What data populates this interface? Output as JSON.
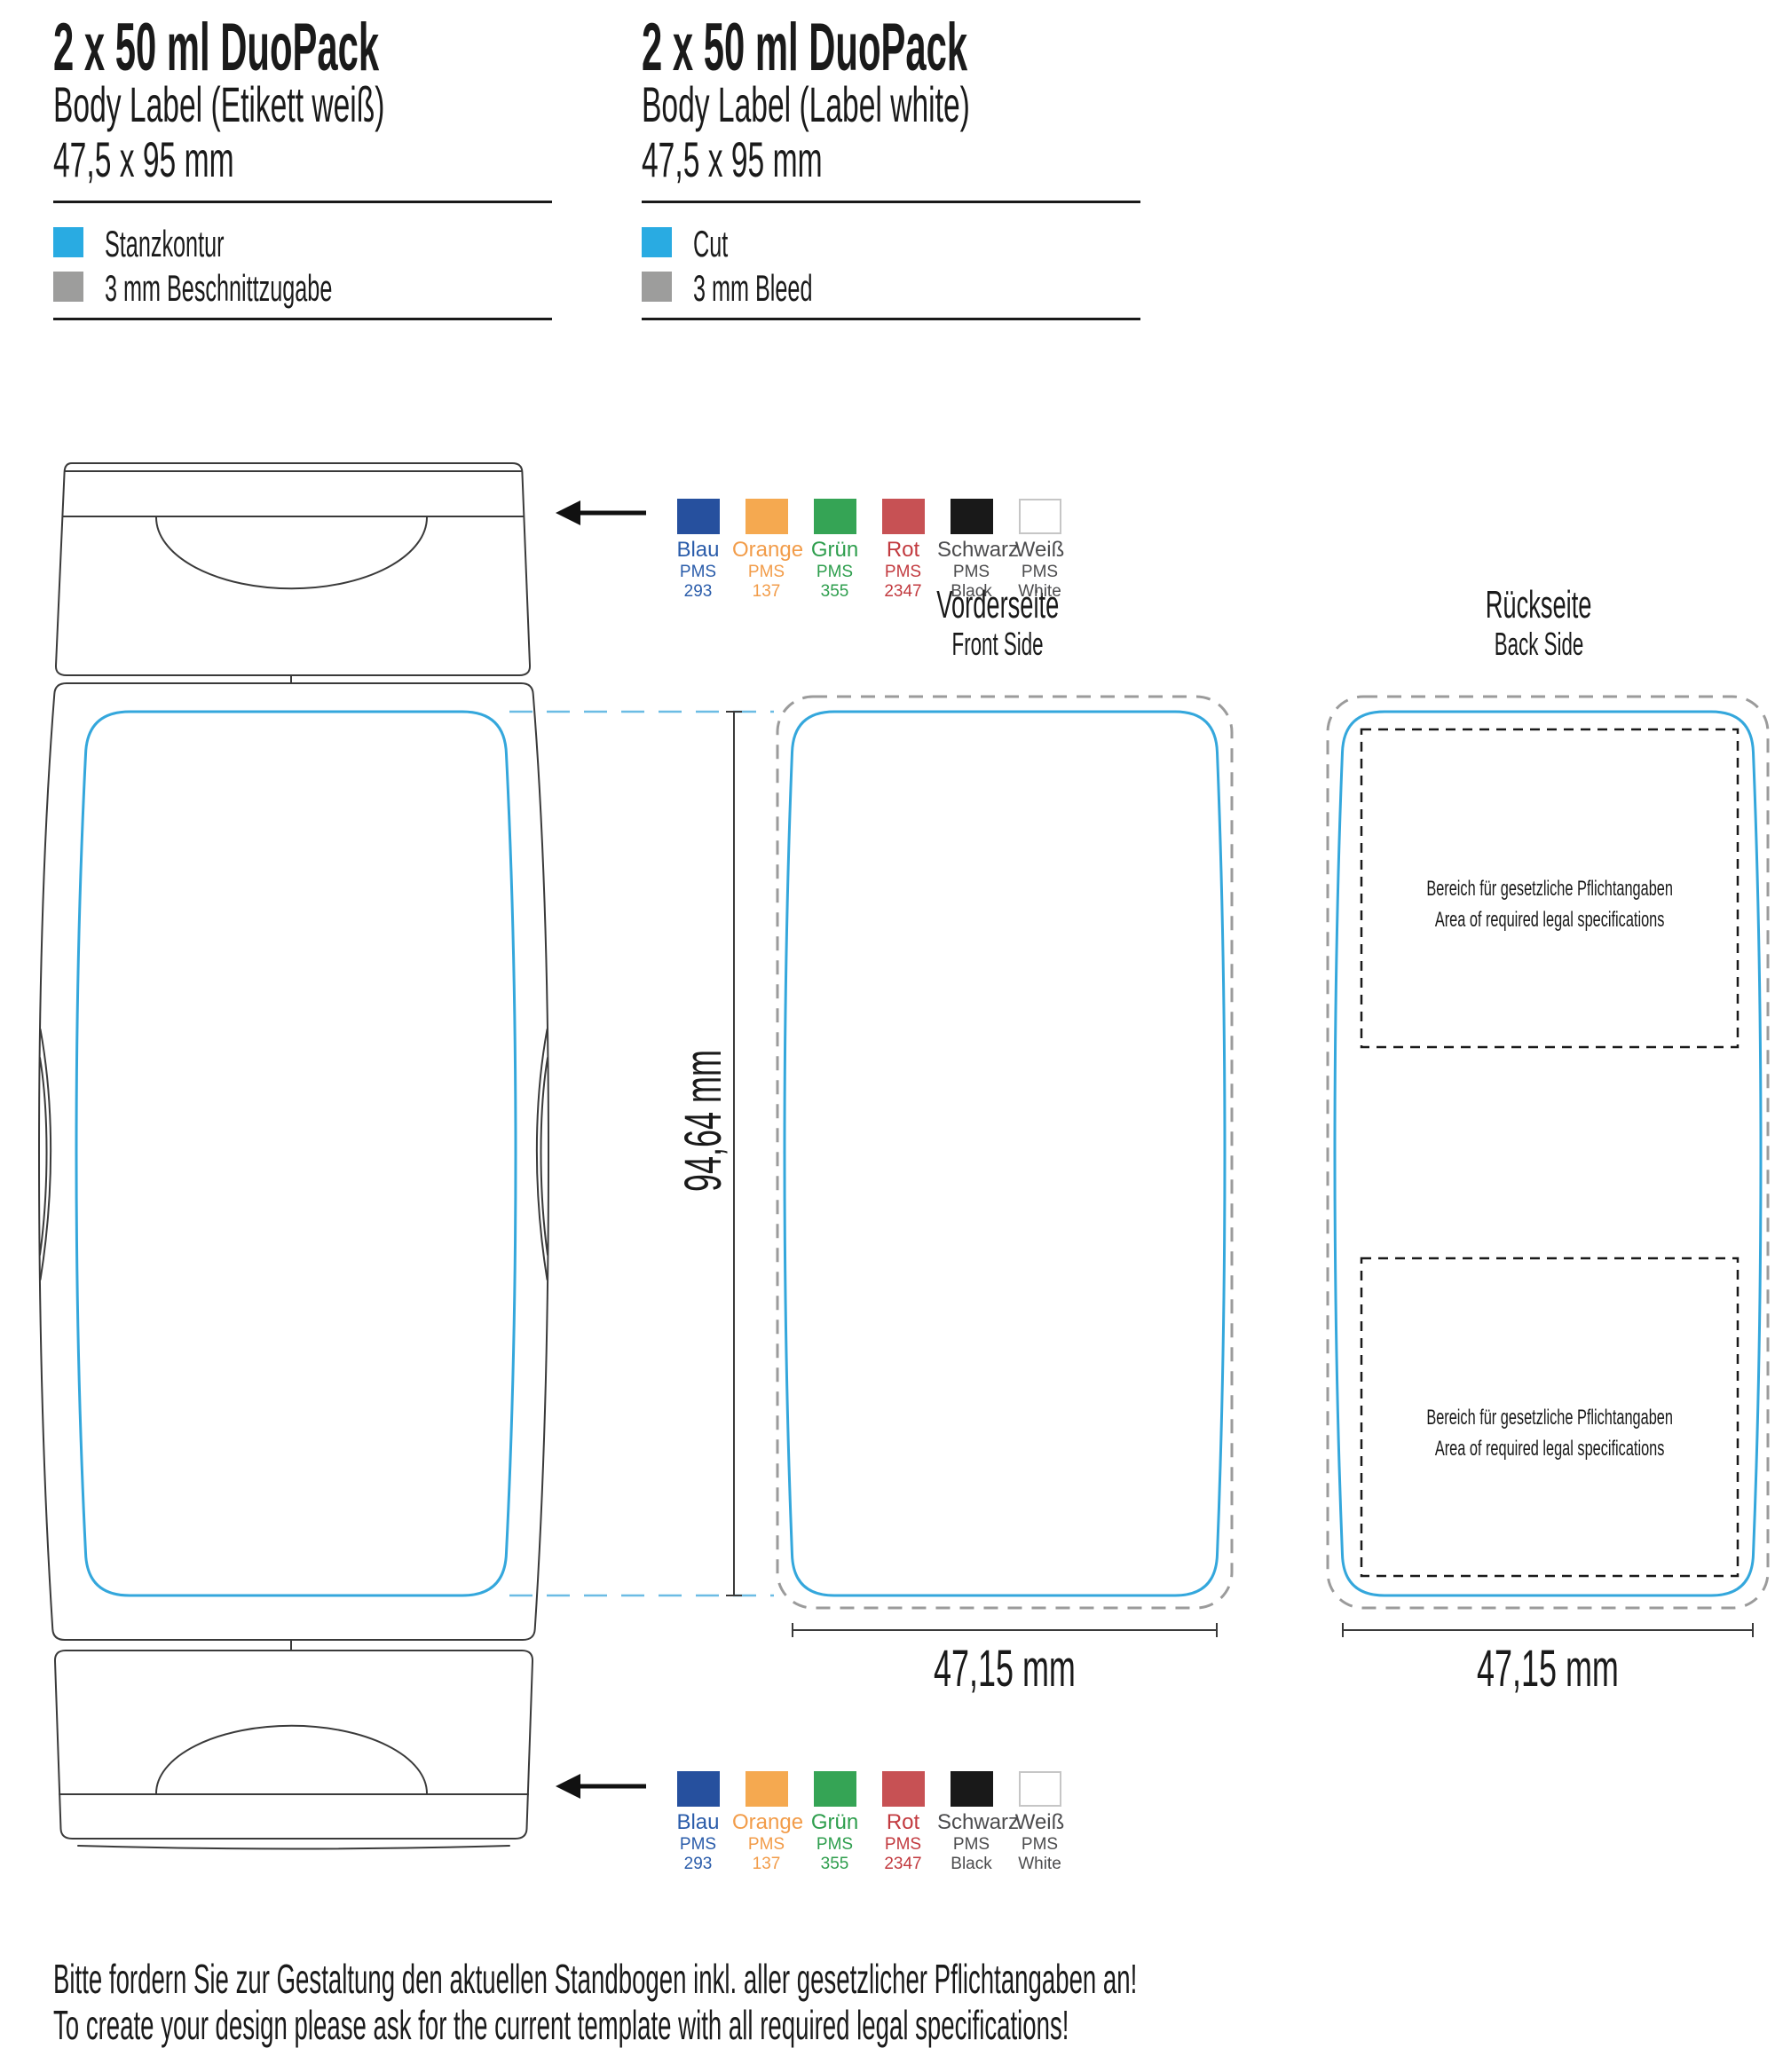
{
  "headers": {
    "de": {
      "title": "2 x 50 ml DuoPack",
      "subtitle": "Body Label (Etikett weiß)",
      "size": "47,5 x 95 mm",
      "legend": [
        {
          "label": "Stanzkontur",
          "color": "#29ABE2"
        },
        {
          "label": "3 mm Beschnittzugabe",
          "color": "#9D9D9C"
        }
      ]
    },
    "en": {
      "title": "2 x 50 ml DuoPack",
      "subtitle": "Body Label (Label white)",
      "size": "47,5 x 95 mm",
      "legend": [
        {
          "label": "Cut",
          "color": "#29ABE2"
        },
        {
          "label": "3 mm Bleed",
          "color": "#9D9D9C"
        }
      ]
    }
  },
  "sides": {
    "front": {
      "title": "Vorderseite",
      "subtitle": "Front Side",
      "width_label": "47,15 mm"
    },
    "back": {
      "title": "Rückseite",
      "subtitle": "Back Side",
      "width_label": "47,15 mm",
      "legal_line1": "Bereich für gesetzliche Pflichtangaben",
      "legal_line2": "Area of required legal specifications"
    }
  },
  "dimensions": {
    "label_height": "94,64 mm"
  },
  "colors": {
    "cut_contour": "#34A7DC",
    "cut_connector": "#6BBCE4",
    "bleed_contour": "#9B9B9B",
    "legal_box": "#1a1a1a",
    "bottle_outline": "#3A3A3A",
    "dimension_line": "#3A3A3A"
  },
  "swatches": {
    "items": [
      {
        "name": "Blau",
        "pms": "PMS 293",
        "hex": "#26509E",
        "text": "#2A5CAA",
        "border": "transparent"
      },
      {
        "name": "Orange",
        "pms": "PMS 137",
        "hex": "#F5A950",
        "text": "#F29C49",
        "border": "transparent"
      },
      {
        "name": "Grün",
        "pms": "PMS 355",
        "hex": "#35A455",
        "text": "#2E9E4D",
        "border": "transparent"
      },
      {
        "name": "Rot",
        "pms": "PMS 2347",
        "hex": "#C75154",
        "text": "#C23A3F",
        "border": "transparent"
      },
      {
        "name": "Schwarz",
        "pms": "PMS Black",
        "hex": "#191919",
        "text": "#4C4C4E",
        "border": "transparent"
      },
      {
        "name": "Weiß",
        "pms": "PMS White",
        "hex": "#FFFFFF",
        "text": "#4C4C4E",
        "border": "#C6C6C6"
      }
    ]
  },
  "footer": {
    "line1": "Bitte fordern Sie zur Gestaltung den aktuellen Standbogen inkl. aller gesetzlicher Pflichtangaben an!",
    "line2": "To create your design please ask for the current template with all required legal specifications!"
  }
}
